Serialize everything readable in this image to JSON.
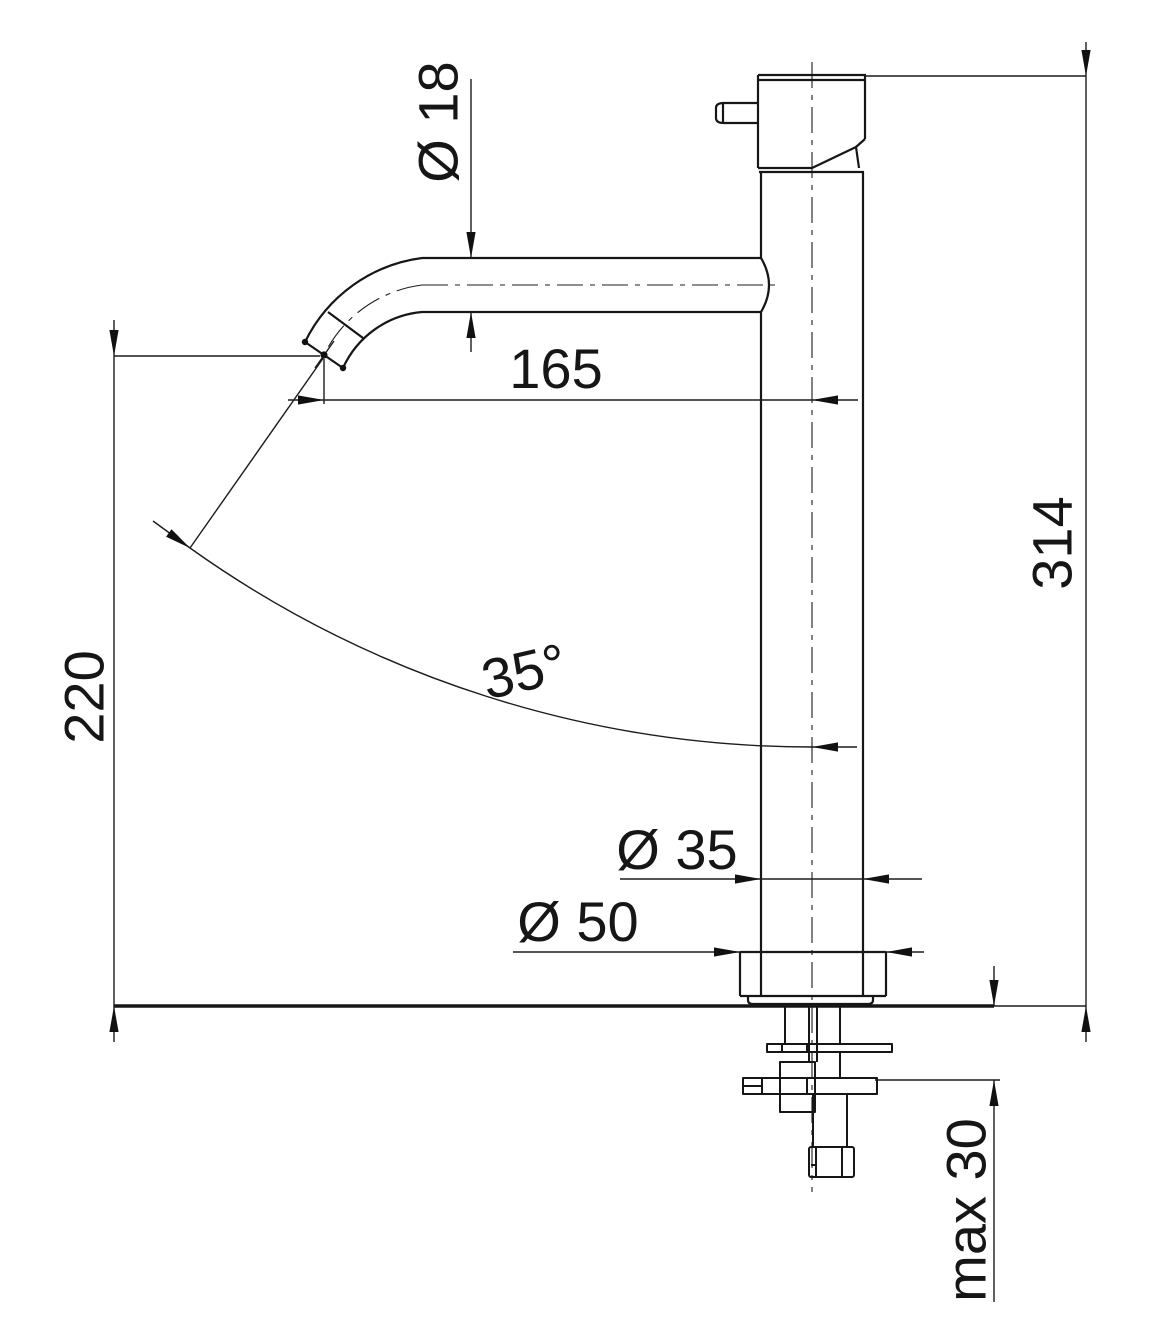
{
  "drawing": {
    "background_color": "#ffffff",
    "line_color": "#161616",
    "dimensions": {
      "spout_diameter": "Ø 18",
      "spout_reach": "165",
      "outlet_height": "220",
      "total_height": "314",
      "spout_angle": "35°",
      "body_diameter": "Ø 35",
      "base_diameter": "Ø 50",
      "max_mounting_thickness": "max 30"
    }
  }
}
